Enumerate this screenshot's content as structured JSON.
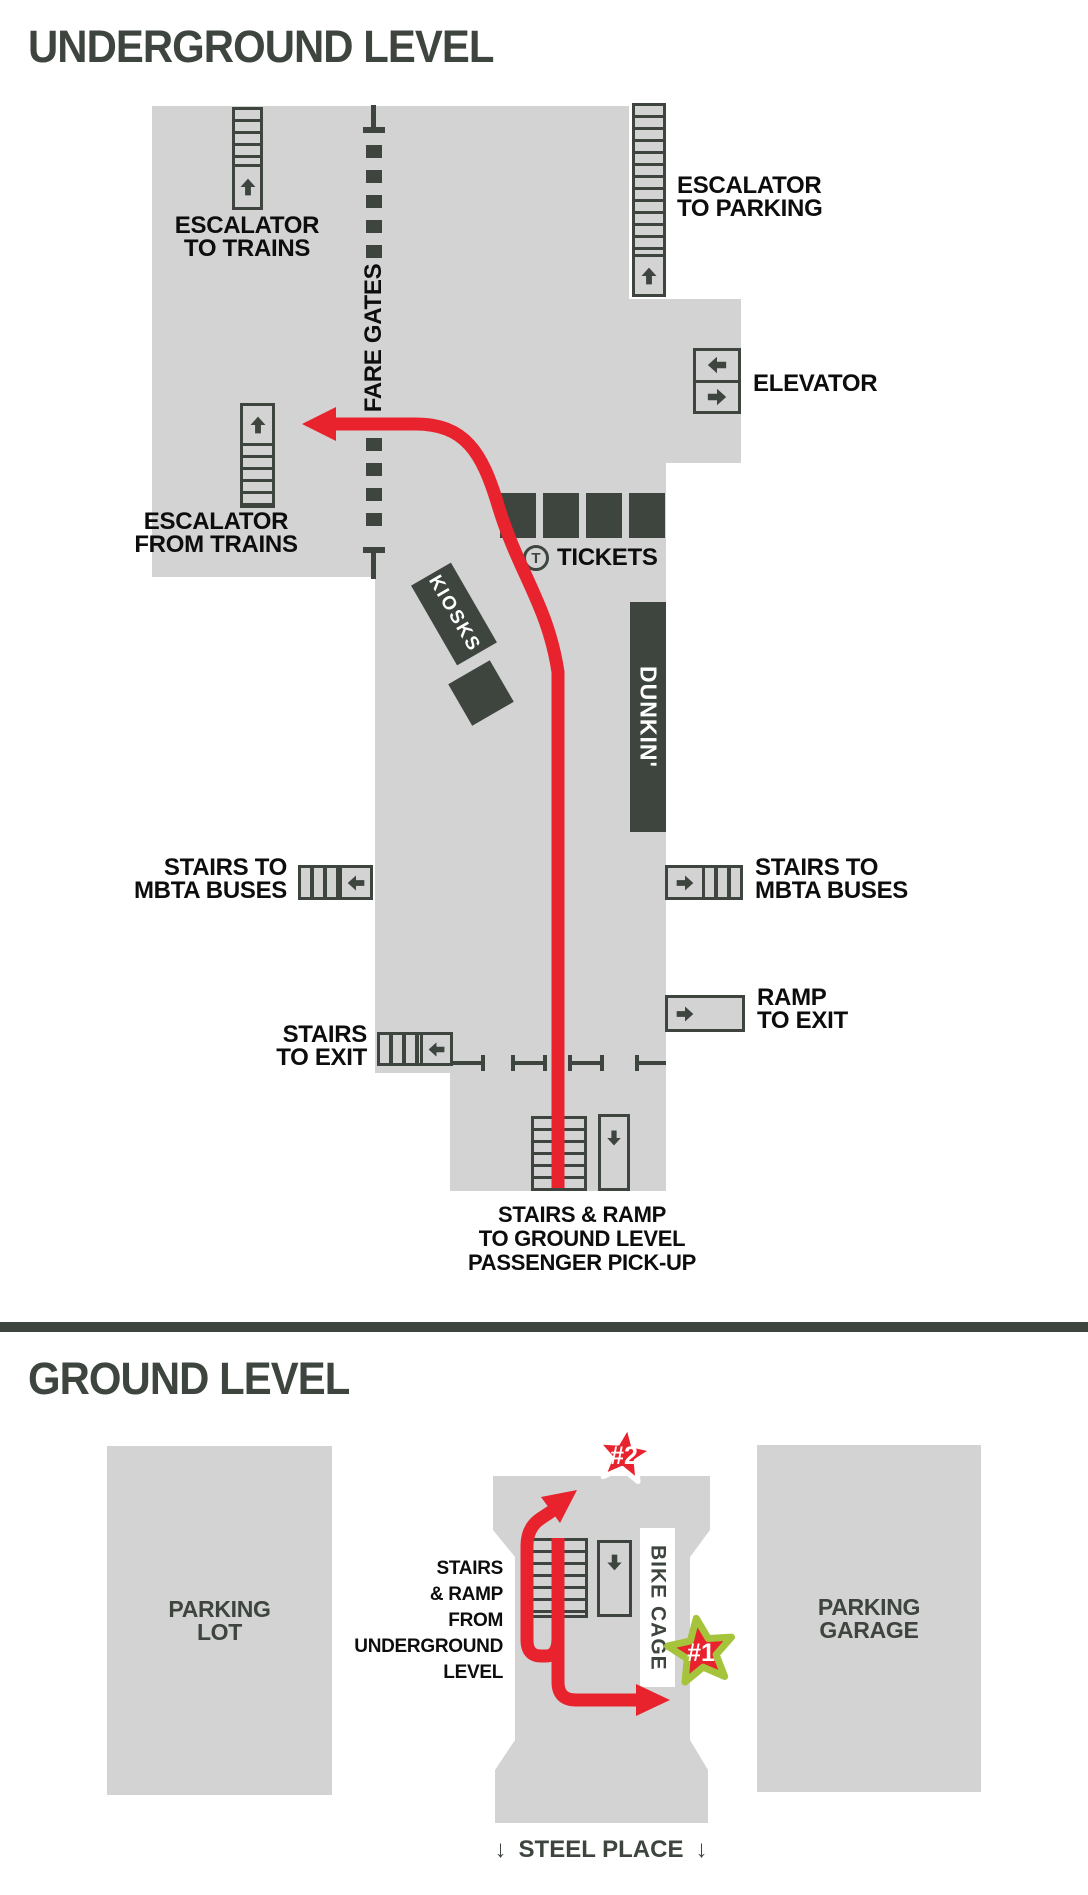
{
  "colors": {
    "floor_gray": "#d3d3d3",
    "dark_green_gray": "#3d453e",
    "label_black": "#0d0d0d",
    "route_red": "#e8232d",
    "star_green": "#a5c43c",
    "white": "#ffffff"
  },
  "underground": {
    "title": "UNDERGROUND LEVEL",
    "escalator_to_trains_label": "ESCALATOR\nTO TRAINS",
    "escalator_to_parking_label": "ESCALATOR\nTO PARKING",
    "fare_gates_label": "FARE GATES",
    "elevator_label": "ELEVATOR",
    "escalator_from_trains_label": "ESCALATOR\nFROM TRAINS",
    "kiosks_label": "KIOSKS",
    "tickets": {
      "t_logo": "T",
      "label": "TICKETS"
    },
    "dunkin_label": "DUNKIN'",
    "stairs_mbta_left_label": "STAIRS TO\nMBTA BUSES",
    "stairs_mbta_right_label": "STAIRS TO\nMBTA BUSES",
    "ramp_to_exit_label": "RAMP\nTO EXIT",
    "stairs_to_exit_label": "STAIRS\nTO EXIT",
    "pickup_label": "STAIRS & RAMP\nTO GROUND LEVEL\nPASSENGER PICK-UP"
  },
  "ground": {
    "title": "GROUND LEVEL",
    "parking_lot_label": "PARKING\nLOT",
    "parking_garage_label": "PARKING\nGARAGE",
    "stairs_ramp_from_label": "STAIRS\n& RAMP\nFROM\nUNDERGROUND\nLEVEL",
    "bike_cage_label": "BIKE CAGE",
    "star_1_label": "#1",
    "star_2_label": "#2",
    "steel_place": {
      "left_arrow": "↓",
      "label": "STEEL PLACE",
      "right_arrow": "↓"
    }
  }
}
